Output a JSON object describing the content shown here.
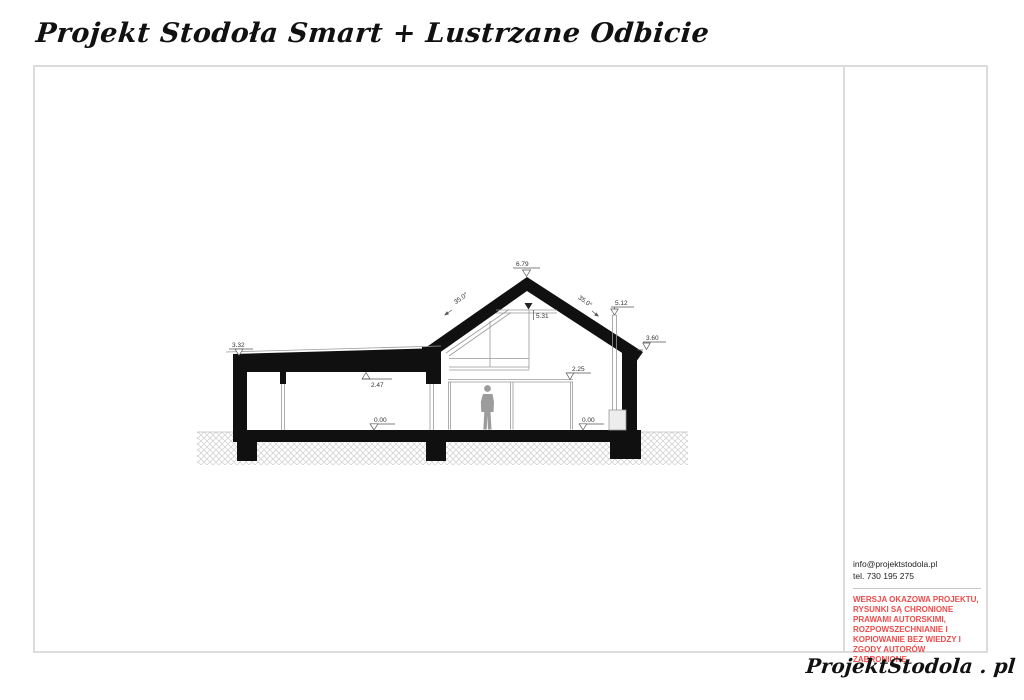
{
  "title": "Projekt Stodoła Smart + Lustrzane Odbicie",
  "drawing": {
    "levels": {
      "left_parapet": "3.32",
      "ceiling": "2.47",
      "floor_left": "0.00",
      "ridge": "6.79",
      "collar_beam": "5.31",
      "chimney_top": "5.12",
      "right_eave": "3.60",
      "door_head": "2.25",
      "floor_right": "0.00"
    },
    "pitch_left": "35.0°",
    "pitch_right": "35.0°"
  },
  "sidebar": {
    "email": "info@projektstodola.pl",
    "phone": "tel. 730 195 275",
    "copyright_notice": "WERSJA OKAZOWA PROJEKTU, RYSUNKI SĄ CHRONIONE PRAWAMI AUTORSKIMI, ROZPOWSZECHNIANIE I KOPIOWANIE BEZ WIEDZY I ZGODY AUTORÓW ZABRONIONE.",
    "notice_color": "#ee4b4b"
  },
  "footer": {
    "logo": "ProjektStodola . pl"
  }
}
